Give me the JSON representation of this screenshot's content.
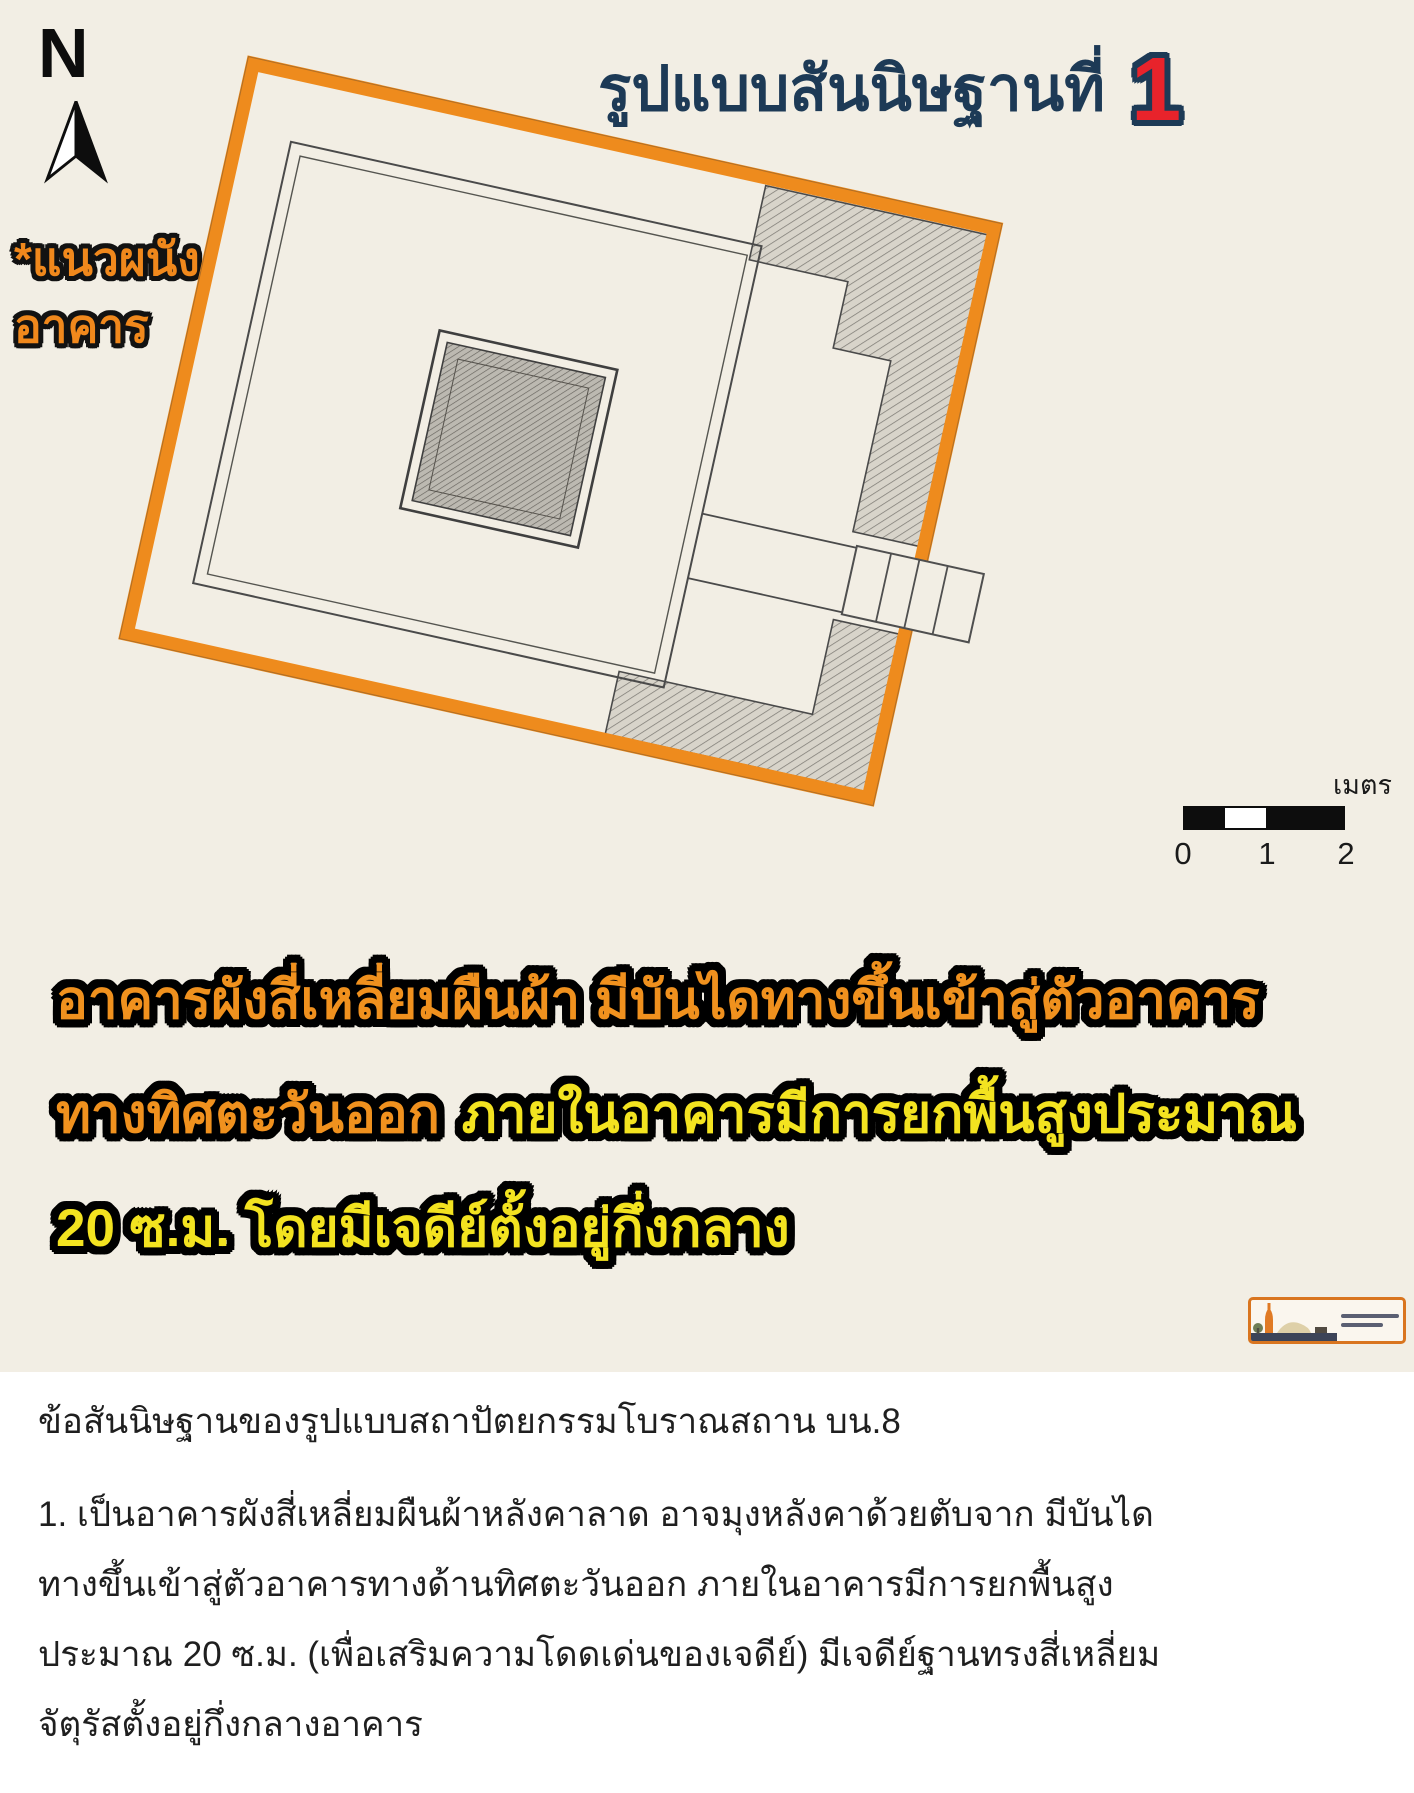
{
  "figure": {
    "title": {
      "text": "รูปแบบสันนิษฐานที่",
      "number": "1"
    },
    "north_label": "N",
    "wall_note": {
      "line1": "*แนวผนัง",
      "line2": "อาคาร"
    },
    "scale_bar": {
      "unit": "เมตร",
      "ticks": [
        "0",
        "1",
        "2"
      ]
    },
    "caption": {
      "line1": "อาคารผังสี่เหลี่ยมผืนผ้า มีบันไดทางขึ้นเข้าสู่ตัวอาคาร",
      "line2_highlight": "ทางทิศตะวันออก",
      "line2_rest": "ภายในอาคารมีการยกพื้นสูงประมาณ",
      "line3": "20 ซ.ม. โดยมีเจดีย์ตั้งอยู่กึ่งกลาง"
    },
    "plan": {
      "type": "archaeological-floor-plan",
      "outline_color": "#ee8b1d",
      "features": [
        "outer-wall-outline",
        "inner-wall-lines",
        "central-chedi-base",
        "hatched-wall-remains",
        "east-staircase"
      ]
    }
  },
  "article": {
    "heading": "ข้อสันนิษฐานของรูปแบบสถาปัตยกรรมโบราณสถาน บน.8",
    "lines": [
      "1. เป็นอาคารผังสี่เหลี่ยมผืนผ้าหลังคาลาด อาจมุงหลังคาด้วยตับจาก มีบันได",
      "ทางขึ้นเข้าสู่ตัวอาคารทางด้านทิศตะวันออก ภายในอาคารมีการยกพื้นสูง",
      "ประมาณ 20 ซ.ม. (เพื่อเสริมความโดดเด่นของเจดีย์) มีเจดีย์ฐานทรงสี่เหลี่ยม",
      "จัตุรัสตั้งอยู่กึ่งกลางอาคาร"
    ]
  },
  "colors": {
    "paper": "#f2eee4",
    "title_navy": "#1d3a56",
    "number_red": "#e8232b",
    "orange": "#ee8b1d",
    "yellow": "#f3e320",
    "text_dark": "#1f1f1f"
  }
}
